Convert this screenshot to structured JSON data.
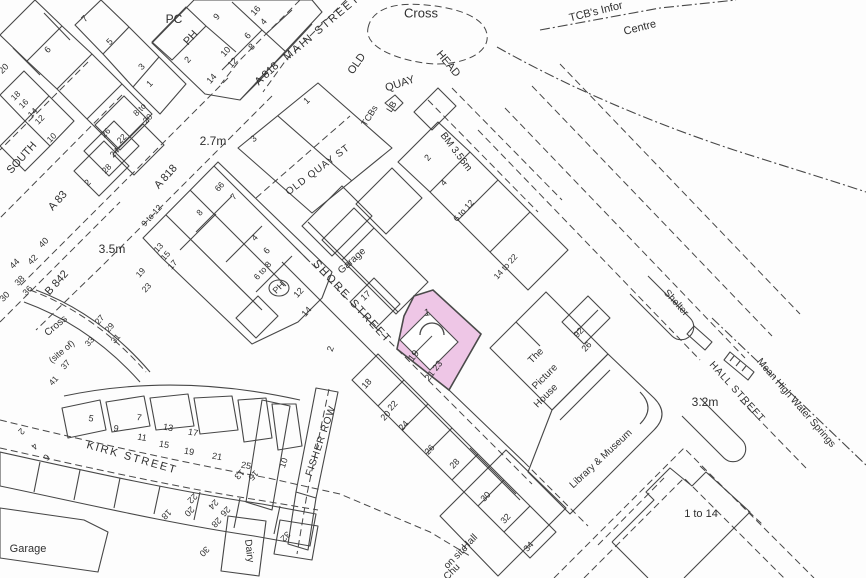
{
  "map": {
    "type": "ordnance-survey-location-plan",
    "colors": {
      "background": "#fdfdfd",
      "line": "#474747",
      "text": "#2f2f2f",
      "highlight_fill": "#eec6e6",
      "highlight_stroke": "#4a4a4a"
    },
    "highlight": {
      "plot_number": "1",
      "house_numbers": "19, 21 23",
      "fill": "#eec6e6"
    },
    "spot_heights": [
      "2.7m",
      "3.5m",
      "3.2m"
    ],
    "benchmark": "BM 3.56m",
    "labels": [
      {
        "t": "Cross",
        "x": 421,
        "y": 14,
        "r": 0,
        "s": 13
      },
      {
        "t": "MAIN STREET",
        "x": 322,
        "y": 28,
        "r": -40,
        "s": 11,
        "ls": 2
      },
      {
        "t": "OLD",
        "x": 357,
        "y": 64,
        "r": -55,
        "s": 11
      },
      {
        "t": "QUAY",
        "x": 400,
        "y": 84,
        "r": -18,
        "s": 11
      },
      {
        "t": "HEAD",
        "x": 448,
        "y": 64,
        "r": 50,
        "s": 11
      },
      {
        "t": "TCB's Infor",
        "x": 596,
        "y": 12,
        "r": -14,
        "s": 11
      },
      {
        "t": "Centre",
        "x": 640,
        "y": 28,
        "r": -14,
        "s": 11
      },
      {
        "t": "PC",
        "x": 174,
        "y": 20,
        "r": 0,
        "s": 12
      },
      {
        "t": "PH",
        "x": 191,
        "y": 38,
        "r": -48,
        "s": 11
      },
      {
        "t": "9",
        "x": 217,
        "y": 17,
        "r": -48,
        "s": 9
      },
      {
        "t": "6",
        "x": 248,
        "y": 36,
        "r": -48,
        "s": 9
      },
      {
        "t": "16",
        "x": 256,
        "y": 11,
        "r": -48,
        "s": 9
      },
      {
        "t": "4",
        "x": 264,
        "y": 22,
        "r": -48,
        "s": 9
      },
      {
        "t": "8",
        "x": 252,
        "y": 47,
        "r": -48,
        "s": 9
      },
      {
        "t": "10",
        "x": 226,
        "y": 52,
        "r": -48,
        "s": 9
      },
      {
        "t": "12",
        "x": 233,
        "y": 63,
        "r": -48,
        "s": 9
      },
      {
        "t": "2",
        "x": 188,
        "y": 60,
        "r": -48,
        "s": 9
      },
      {
        "t": "14",
        "x": 212,
        "y": 79,
        "r": -48,
        "s": 9
      },
      {
        "t": "A 818",
        "x": 267,
        "y": 74,
        "r": -43,
        "s": 11
      },
      {
        "t": "A 818",
        "x": 166,
        "y": 177,
        "r": -48,
        "s": 11
      },
      {
        "t": "2.7m",
        "x": 213,
        "y": 142,
        "r": 0,
        "s": 12
      },
      {
        "t": "1",
        "x": 307,
        "y": 101,
        "r": -43,
        "s": 9
      },
      {
        "t": "3",
        "x": 254,
        "y": 139,
        "r": -43,
        "s": 9
      },
      {
        "t": "OLD QUAY ST",
        "x": 318,
        "y": 170,
        "r": -37,
        "s": 10,
        "ls": 1
      },
      {
        "t": "TCBs",
        "x": 370,
        "y": 116,
        "r": -58,
        "s": 9
      },
      {
        "t": "LB",
        "x": 392,
        "y": 107,
        "r": -58,
        "s": 9
      },
      {
        "t": "BM 3.56m",
        "x": 456,
        "y": 152,
        "r": 53,
        "s": 10
      },
      {
        "t": "SOUTH",
        "x": 22,
        "y": 158,
        "r": -48,
        "s": 11
      },
      {
        "t": "A 83",
        "x": 58,
        "y": 201,
        "r": -48,
        "s": 11
      },
      {
        "t": "3.5m",
        "x": 112,
        "y": 250,
        "r": 0,
        "s": 12
      },
      {
        "t": "B 842",
        "x": 57,
        "y": 283,
        "r": -48,
        "s": 11
      },
      {
        "t": "Cross",
        "x": 56,
        "y": 326,
        "r": -40,
        "s": 10
      },
      {
        "t": "(site of)",
        "x": 62,
        "y": 352,
        "r": -40,
        "s": 9
      },
      {
        "t": "Shelter",
        "x": 676,
        "y": 303,
        "r": 48,
        "s": 10
      },
      {
        "t": "HALL STREET",
        "x": 737,
        "y": 392,
        "r": 48,
        "s": 10,
        "ls": 1
      },
      {
        "t": "Mean High Water Springs",
        "x": 796,
        "y": 403,
        "r": 49,
        "s": 10
      },
      {
        "t": "3.2m",
        "x": 705,
        "y": 403,
        "r": 0,
        "s": 12
      },
      {
        "t": "SHORE STREET",
        "x": 352,
        "y": 302,
        "r": 47,
        "s": 11,
        "ls": 2
      },
      {
        "t": "Garage",
        "x": 352,
        "y": 261,
        "r": -42,
        "s": 10
      },
      {
        "t": "17",
        "x": 366,
        "y": 296,
        "r": -42,
        "s": 9
      },
      {
        "t": "KIRK STREET",
        "x": 132,
        "y": 458,
        "r": 16,
        "s": 11,
        "ls": 2
      },
      {
        "t": "FISHER ROW",
        "x": 321,
        "y": 441,
        "r": -71,
        "s": 10,
        "ls": 1
      },
      {
        "t": "The",
        "x": 536,
        "y": 356,
        "r": -45,
        "s": 10
      },
      {
        "t": "Picture",
        "x": 545,
        "y": 377,
        "r": -45,
        "s": 10
      },
      {
        "t": "House",
        "x": 546,
        "y": 396,
        "r": -45,
        "s": 10
      },
      {
        "t": "Library & Museum",
        "x": 601,
        "y": 459,
        "r": -43,
        "s": 10
      },
      {
        "t": "1 to 14",
        "x": 701,
        "y": 514,
        "r": 0,
        "s": 11
      },
      {
        "t": "Hall",
        "x": 470,
        "y": 542,
        "r": -45,
        "s": 10
      },
      {
        "t": "on site",
        "x": 456,
        "y": 557,
        "r": -45,
        "s": 10
      },
      {
        "t": "Chu",
        "x": 452,
        "y": 572,
        "r": -45,
        "s": 10
      },
      {
        "t": "Garage",
        "x": 28,
        "y": 549,
        "r": 0,
        "s": 11
      },
      {
        "t": "Dairy",
        "x": 249,
        "y": 551,
        "r": 83,
        "s": 10
      },
      {
        "t": "1",
        "x": 427,
        "y": 313,
        "r": -8,
        "s": 10
      },
      {
        "t": "19",
        "x": 414,
        "y": 356,
        "r": -52,
        "s": 10
      },
      {
        "t": "21 23",
        "x": 434,
        "y": 371,
        "r": -52,
        "s": 9
      },
      {
        "t": "PH",
        "x": 279,
        "y": 288,
        "r": -45,
        "s": 9
      },
      {
        "t": "92",
        "x": 579,
        "y": 333,
        "r": -48,
        "s": 9
      },
      {
        "t": "26",
        "x": 587,
        "y": 347,
        "r": -48,
        "s": 9
      },
      {
        "t": "2",
        "x": 428,
        "y": 158,
        "r": -48,
        "s": 9
      },
      {
        "t": "4",
        "x": 444,
        "y": 183,
        "r": -48,
        "s": 9
      },
      {
        "t": "6 to 12",
        "x": 464,
        "y": 211,
        "r": -48,
        "s": 8.5
      },
      {
        "t": "14 to 22",
        "x": 506,
        "y": 267,
        "r": -48,
        "s": 8.5
      },
      {
        "t": "9 to 12",
        "x": 152,
        "y": 216,
        "r": -48,
        "s": 8.5
      },
      {
        "t": "13",
        "x": 159,
        "y": 248,
        "r": -48,
        "s": 8.5
      },
      {
        "t": "15",
        "x": 166,
        "y": 256,
        "r": -48,
        "s": 8.5
      },
      {
        "t": "17",
        "x": 173,
        "y": 265,
        "r": -48,
        "s": 8.5
      },
      {
        "t": "19",
        "x": 141,
        "y": 273,
        "r": -48,
        "s": 8.5
      },
      {
        "t": "23",
        "x": 147,
        "y": 288,
        "r": -48,
        "s": 8.5
      },
      {
        "t": "4",
        "x": 255,
        "y": 238,
        "r": -48,
        "s": 9
      },
      {
        "t": "6",
        "x": 267,
        "y": 251,
        "r": -48,
        "s": 9
      },
      {
        "t": "6 to 8",
        "x": 263,
        "y": 271,
        "r": -48,
        "s": 8.5
      },
      {
        "t": "12",
        "x": 299,
        "y": 293,
        "r": -48,
        "s": 9
      },
      {
        "t": "14",
        "x": 307,
        "y": 312,
        "r": -48,
        "s": 9
      },
      {
        "t": "66",
        "x": 220,
        "y": 187,
        "r": -48,
        "s": 8.5
      },
      {
        "t": "7",
        "x": 234,
        "y": 197,
        "r": -48,
        "s": 8.5
      },
      {
        "t": "8",
        "x": 200,
        "y": 213,
        "r": -48,
        "s": 8.5
      },
      {
        "t": "18",
        "x": 367,
        "y": 384,
        "r": -48,
        "s": 9
      },
      {
        "t": "22",
        "x": 393,
        "y": 406,
        "r": -48,
        "s": 9
      },
      {
        "t": "20",
        "x": 386,
        "y": 416,
        "r": -48,
        "s": 9
      },
      {
        "t": "24",
        "x": 404,
        "y": 426,
        "r": -48,
        "s": 9
      },
      {
        "t": "26",
        "x": 430,
        "y": 450,
        "r": -48,
        "s": 9
      },
      {
        "t": "28",
        "x": 455,
        "y": 464,
        "r": -48,
        "s": 9
      },
      {
        "t": "30",
        "x": 486,
        "y": 497,
        "r": -48,
        "s": 9
      },
      {
        "t": "32",
        "x": 506,
        "y": 519,
        "r": -48,
        "s": 9
      },
      {
        "t": "34",
        "x": 529,
        "y": 547,
        "r": -48,
        "s": 9
      },
      {
        "t": "5",
        "x": 91,
        "y": 419,
        "r": 10,
        "s": 9
      },
      {
        "t": "9",
        "x": 116,
        "y": 429,
        "r": 10,
        "s": 9
      },
      {
        "t": "7",
        "x": 139,
        "y": 418,
        "r": 10,
        "s": 9
      },
      {
        "t": "11",
        "x": 142,
        "y": 438,
        "r": 10,
        "s": 9
      },
      {
        "t": "13",
        "x": 168,
        "y": 428,
        "r": 10,
        "s": 9
      },
      {
        "t": "15",
        "x": 164,
        "y": 445,
        "r": 10,
        "s": 9
      },
      {
        "t": "17",
        "x": 193,
        "y": 433,
        "r": 10,
        "s": 9
      },
      {
        "t": "19",
        "x": 189,
        "y": 452,
        "r": 10,
        "s": 9
      },
      {
        "t": "21",
        "x": 217,
        "y": 457,
        "r": 10,
        "s": 9
      },
      {
        "t": "25",
        "x": 246,
        "y": 466,
        "r": 10,
        "s": 9
      },
      {
        "t": "2",
        "x": 331,
        "y": 349,
        "r": -71,
        "s": 9
      },
      {
        "t": "10",
        "x": 284,
        "y": 463,
        "r": -71,
        "s": 9
      },
      {
        "t": "2",
        "x": 21,
        "y": 431,
        "r": 135,
        "s": 9
      },
      {
        "t": "4",
        "x": 34,
        "y": 446,
        "r": 135,
        "s": 9
      },
      {
        "t": "6",
        "x": 46,
        "y": 457,
        "r": 135,
        "s": 9
      },
      {
        "t": "18",
        "x": 166,
        "y": 514,
        "r": 135,
        "s": 9
      },
      {
        "t": "20",
        "x": 189,
        "y": 511,
        "r": 135,
        "s": 9
      },
      {
        "t": "22",
        "x": 192,
        "y": 498,
        "r": 135,
        "s": 9
      },
      {
        "t": "24",
        "x": 213,
        "y": 504,
        "r": 135,
        "s": 9
      },
      {
        "t": "26",
        "x": 225,
        "y": 511,
        "r": 135,
        "s": 9
      },
      {
        "t": "28",
        "x": 216,
        "y": 522,
        "r": 135,
        "s": 9
      },
      {
        "t": "30",
        "x": 204,
        "y": 551,
        "r": 135,
        "s": 9
      },
      {
        "t": "32",
        "x": 285,
        "y": 536,
        "r": 135,
        "s": 9
      },
      {
        "t": "13",
        "x": 239,
        "y": 474,
        "r": 135,
        "s": 9
      },
      {
        "t": "15",
        "x": 253,
        "y": 475,
        "r": 135,
        "s": 9
      },
      {
        "t": "7",
        "x": 85,
        "y": 19,
        "r": -45,
        "s": 9
      },
      {
        "t": "5",
        "x": 110,
        "y": 42,
        "r": -45,
        "s": 9
      },
      {
        "t": "3",
        "x": 142,
        "y": 67,
        "r": -45,
        "s": 9
      },
      {
        "t": "1",
        "x": 150,
        "y": 84,
        "r": -45,
        "s": 9
      },
      {
        "t": "6",
        "x": 48,
        "y": 50,
        "r": -45,
        "s": 9
      },
      {
        "t": "18",
        "x": 16,
        "y": 96,
        "r": -45,
        "s": 8.5
      },
      {
        "t": "16",
        "x": 24,
        "y": 104,
        "r": -45,
        "s": 8.5
      },
      {
        "t": "14",
        "x": 33,
        "y": 113,
        "r": -45,
        "s": 8.5
      },
      {
        "t": "12",
        "x": 40,
        "y": 120,
        "r": -45,
        "s": 8.5
      },
      {
        "t": "10",
        "x": 52,
        "y": 138,
        "r": -45,
        "s": 8.5
      },
      {
        "t": "8 to",
        "x": 140,
        "y": 110,
        "r": -45,
        "s": 8.5
      },
      {
        "t": "20",
        "x": 148,
        "y": 119,
        "r": -45,
        "s": 8.5
      },
      {
        "t": "26",
        "x": 106,
        "y": 133,
        "r": -45,
        "s": 8.5
      },
      {
        "t": "22",
        "x": 122,
        "y": 139,
        "r": -45,
        "s": 8.5
      },
      {
        "t": "24",
        "x": 115,
        "y": 153,
        "r": -45,
        "s": 8.5
      },
      {
        "t": "28",
        "x": 107,
        "y": 169,
        "r": -45,
        "s": 8.5
      },
      {
        "t": "2",
        "x": 88,
        "y": 183,
        "r": -45,
        "s": 9
      },
      {
        "t": "20",
        "x": 4,
        "y": 69,
        "r": -45,
        "s": 9
      },
      {
        "t": "40",
        "x": 44,
        "y": 243,
        "r": -45,
        "s": 9
      },
      {
        "t": "42",
        "x": 33,
        "y": 260,
        "r": -45,
        "s": 9
      },
      {
        "t": "44",
        "x": 15,
        "y": 264,
        "r": -45,
        "s": 9
      },
      {
        "t": "38",
        "x": 20,
        "y": 281,
        "r": -45,
        "s": 9
      },
      {
        "t": "36",
        "x": 28,
        "y": 291,
        "r": -45,
        "s": 9
      },
      {
        "t": "30",
        "x": 5,
        "y": 297,
        "r": -45,
        "s": 9
      },
      {
        "t": "27",
        "x": 100,
        "y": 320,
        "r": -48,
        "s": 8.5
      },
      {
        "t": "29",
        "x": 110,
        "y": 328,
        "r": -48,
        "s": 8.5
      },
      {
        "t": "31",
        "x": 116,
        "y": 339,
        "r": -48,
        "s": 8.5
      },
      {
        "t": "33",
        "x": 90,
        "y": 342,
        "r": -48,
        "s": 8.5
      },
      {
        "t": "37",
        "x": 66,
        "y": 365,
        "r": -48,
        "s": 8.5
      },
      {
        "t": "41",
        "x": 54,
        "y": 381,
        "r": -48,
        "s": 8.5
      }
    ]
  }
}
